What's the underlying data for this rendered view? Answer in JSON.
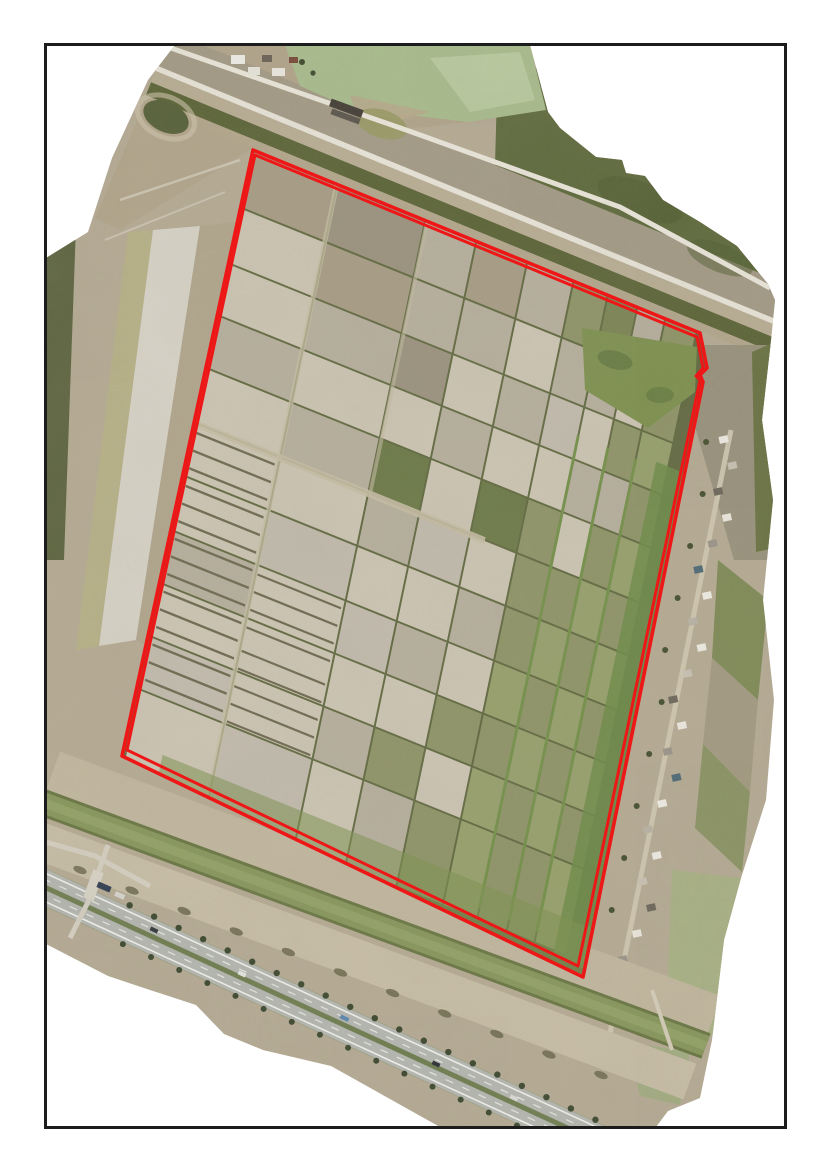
{
  "figure": {
    "frame": {
      "x": 45.5,
      "y": 44.5,
      "width": 740,
      "height": 1083,
      "stroke_color": "#1c1c1c",
      "stroke_width": 3,
      "background": "#ffffff"
    },
    "boundary": {
      "color": "#ee1717",
      "outer": {
        "points": "253,150 700,333 707,368 700,375 703,382 583,977 122,756",
        "width": 3.6
      },
      "inner": {
        "points": "255,155 697,337 703,368 696,376 700,380 578,966 127,750",
        "width": 3.0
      }
    },
    "field_grid": {
      "origin": [
        253,
        150
      ],
      "u_axis": [
        0.927,
        0.375
      ],
      "v_axis": [
        -0.205,
        0.979
      ],
      "divider_color": "#626a42",
      "cols": [
        [
          0,
          90
        ],
        [
          92,
          185
        ],
        [
          187,
          240
        ],
        [
          242,
          295
        ],
        [
          297,
          345
        ],
        [
          347,
          382
        ],
        [
          384,
          414
        ],
        [
          416,
          444
        ],
        [
          446,
          478
        ]
      ],
      "rows": [
        [
          0,
          58
        ],
        [
          60,
          115
        ],
        [
          117,
          168
        ],
        [
          170,
          222
        ],
        [
          224,
          278
        ],
        [
          280,
          332
        ],
        [
          334,
          388
        ],
        [
          390,
          442
        ],
        [
          444,
          496
        ],
        [
          498,
          550
        ],
        [
          552,
          638
        ]
      ],
      "palette": [
        "#a89c85",
        "#b7af9e",
        "#cdc5b4",
        "#9b937f",
        "#8f9468",
        "#7b8454",
        "#6d7a49",
        "#c2bbae",
        "#97a06d",
        "#b3a88d"
      ],
      "cells": [
        [
          0,
          3,
          1,
          0,
          1,
          4,
          5,
          1,
          4
        ],
        [
          2,
          0,
          1,
          1,
          2,
          1,
          1,
          2,
          4
        ],
        [
          2,
          1,
          3,
          2,
          1,
          7,
          2,
          4,
          8
        ],
        [
          1,
          2,
          2,
          1,
          2,
          2,
          1,
          1,
          4
        ],
        [
          2,
          1,
          6,
          2,
          6,
          4,
          2,
          4,
          8
        ],
        [
          2,
          2,
          1,
          7,
          2,
          4,
          4,
          8,
          4
        ],
        [
          2,
          7,
          2,
          2,
          1,
          4,
          8,
          4,
          8
        ],
        [
          1,
          2,
          7,
          1,
          2,
          8,
          4,
          8,
          4
        ],
        [
          2,
          2,
          2,
          2,
          4,
          4,
          8,
          4,
          8
        ],
        [
          7,
          2,
          1,
          4,
          2,
          8,
          4,
          8,
          4
        ],
        [
          2,
          7,
          2,
          1,
          4,
          8,
          4,
          4,
          8
        ]
      ]
    },
    "village": {
      "count": 22,
      "start_y": 436,
      "spacing": 26,
      "roof_colors": [
        "#f0ede6",
        "#c9c2b5",
        "#6e675c",
        "#ece8df",
        "#9b948a",
        "#4e6a78",
        "#efece4",
        "#b9b3a6"
      ],
      "tree_color": "#45502f"
    },
    "palette": {
      "base_dirt": "#b6ab95",
      "dark_water": "#5f6a3d",
      "canal_green": "#87965c",
      "pale_pond": "#a9bd8e",
      "sage_water": "#a9b286",
      "highway_gray": "#b5b7b2",
      "bright_strip": "#d7d3c8",
      "road_light": "#e9e5da"
    }
  }
}
